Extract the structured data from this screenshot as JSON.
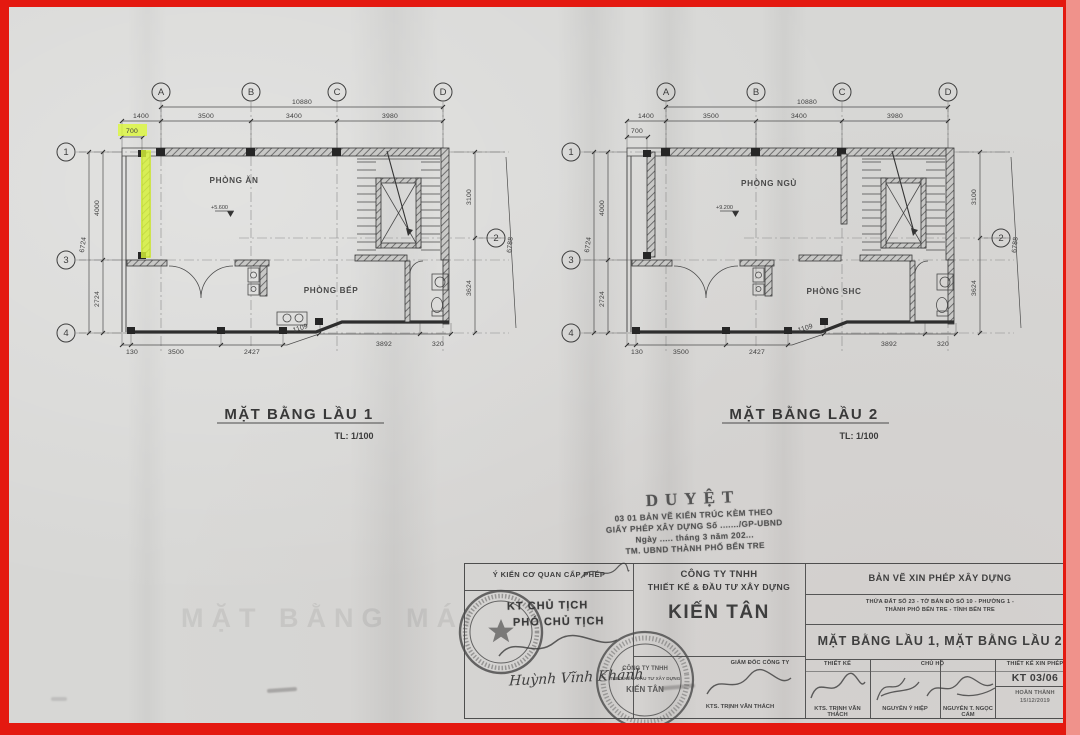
{
  "frame": {
    "border_color": "#e41910",
    "paper_color": "#d7d7d5",
    "highlight_color": "#dcf83a"
  },
  "plans": [
    {
      "title": "MẶT BẰNG LẦU 1",
      "scale_label": "TL: 1/100",
      "room_top": "PHÒNG ĂN",
      "room_bottom": "PHÒNG BẾP",
      "level": "+5.600",
      "grid": {
        "A": "A",
        "B": "B",
        "C": "C",
        "D": "D",
        "r1": "1",
        "r2": "2",
        "r3": "3",
        "r4": "4"
      },
      "dims": {
        "total_top": "10880",
        "seg1": "1400",
        "seg2": "3500",
        "seg3": "3400",
        "seg4": "3980",
        "offset": "700",
        "left_total": "6724",
        "left1": "4000",
        "left2": "2724",
        "right1": "3100",
        "right2": "3624",
        "right_total": "6788",
        "b1": "130",
        "b2": "3500",
        "b3": "2427",
        "b4": "1109",
        "b5": "3892",
        "b6": "320"
      }
    },
    {
      "title": "MẶT BẰNG LẦU 2",
      "scale_label": "TL: 1/100",
      "room_top": "PHÒNG NGỦ",
      "room_bottom": "PHÒNG SHC",
      "level": "+9.200",
      "grid": {
        "A": "A",
        "B": "B",
        "C": "C",
        "D": "D",
        "r1": "1",
        "r2": "2",
        "r3": "3",
        "r4": "4"
      },
      "dims": {
        "total_top": "10880",
        "seg1": "1400",
        "seg2": "3500",
        "seg3": "3400",
        "seg4": "3980",
        "offset": "700",
        "left_total": "6724",
        "left1": "4000",
        "left2": "2724",
        "right1": "3100",
        "right2": "3624",
        "right_total": "6788",
        "b1": "130",
        "b2": "3500",
        "b3": "2427",
        "b4": "1109",
        "b5": "3892",
        "b6": "320"
      }
    }
  ],
  "approval_stamp": {
    "title": "DUYỆT",
    "line1": "03 01 BẢN VẼ KIẾN TRÚC KÈM THEO",
    "line2": "GIẤY PHÉP XÂY DỰNG Số ......./GP-UBND",
    "line3": "Ngày ..... tháng 3 năm 202...",
    "line4": "TM. UBND THÀNH PHỐ BẾN TRE"
  },
  "title_block": {
    "permit_opinion_header": "Ý KIẾN CƠ QUAN CẤP PHÉP",
    "kt_line1": "KT CHỦ TỊCH",
    "kt_line2": "PHÓ CHỦ TỊCH",
    "signature_name": "Huỳnh Vĩnh Khánh",
    "company": {
      "line1": "CÔNG TY TNHH",
      "line2": "THIẾT KẾ & ĐẦU TƯ XÂY DỰNG",
      "name": "KIẾN TÂN",
      "director_header": "GIÁM ĐỐC CÔNG TY",
      "director_name": "KTS. TRỊNH VĂN THÁCH"
    },
    "drawing_type": "BẢN VẼ XIN PHÉP XÂY DỰNG",
    "parcel_line1": "THỬA ĐẤT SỐ 23 - TỜ BẢN ĐỒ SỐ 10 - PHƯỜNG 1 -",
    "parcel_line2": "THÀNH PHỐ BẾN TRE - TỈNH BẾN TRE",
    "sheet_title": "MẶT BẰNG LẦU 1, MẶT BẰNG LẦU 2",
    "designer_header": "THIẾT KẾ",
    "designer_name": "KTS. TRỊNH VĂN THÁCH",
    "owner_header": "CHỦ HỘ",
    "owner_name1": "NGUYỄN Ỷ HIỆP",
    "owner_name2": "NGUYỄN T. NGỌC CẨM",
    "sheet_no_header": "THIẾT KẾ XIN PHÉP",
    "sheet_no": "KT 03/06",
    "completion_label": "HOÀN THÀNH",
    "completion_date": "15/12/2019"
  },
  "ghost_text": "MẶT BẰNG MÁI"
}
